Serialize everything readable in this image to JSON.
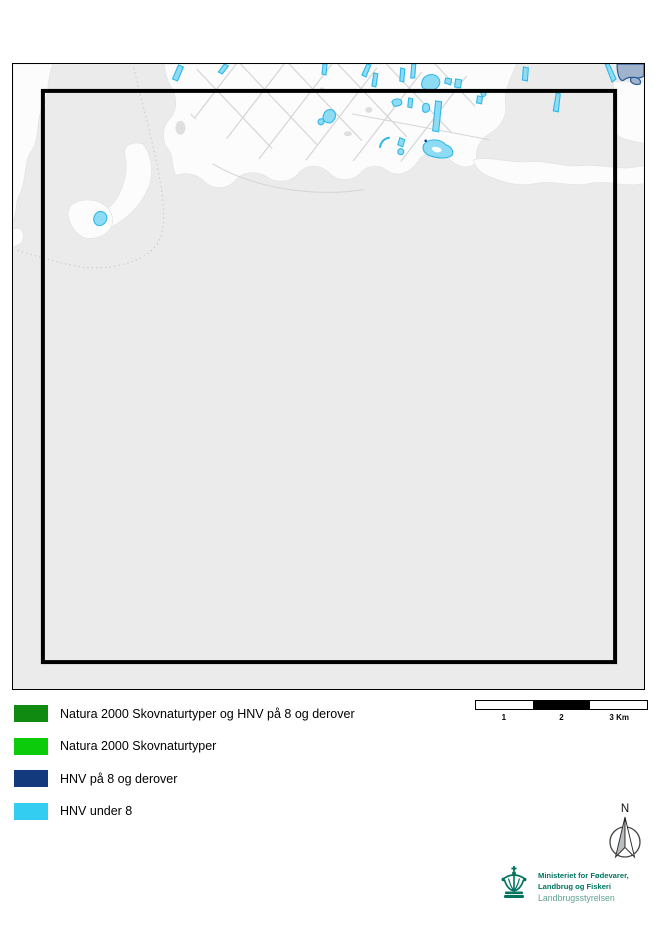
{
  "map": {
    "colors": {
      "background": "#ebebeb",
      "land": "#fcfcfd",
      "land_stroke": "#e2e3e5",
      "road": "#d4d5d7",
      "boundary": "#c9c9c9",
      "hnv_under8_fill": "#8edcf4",
      "hnv_under8_stroke": "#2fb7e8",
      "hnv8_fill": "#9fb3cc",
      "hnv8_stroke": "#2a5a96",
      "frame": "#000000",
      "extent_box": "#000000"
    }
  },
  "legend": {
    "items": [
      {
        "label": "Natura 2000 Skovnaturtyper og HNV på 8 og derover",
        "color": "#108a10"
      },
      {
        "label": "Natura 2000 Skovnaturtyper",
        "color": "#0bcb0b"
      },
      {
        "label": "HNV på 8 og derover",
        "color": "#123a7d"
      },
      {
        "label": "HNV under 8",
        "color": "#33cdf2"
      }
    ]
  },
  "scalebar": {
    "labels": [
      "1",
      "2",
      "3 Km"
    ],
    "segments": [
      "#ffffff",
      "#000000",
      "#ffffff"
    ]
  },
  "north_arrow": {
    "label": "N"
  },
  "logo": {
    "org_line1": "Ministeriet for Fødevarer,",
    "org_line2": "Landbrug og Fiskeri",
    "agency": "Landbrugsstyrelsen",
    "color": "#00735f",
    "agency_color": "#5fa092"
  }
}
